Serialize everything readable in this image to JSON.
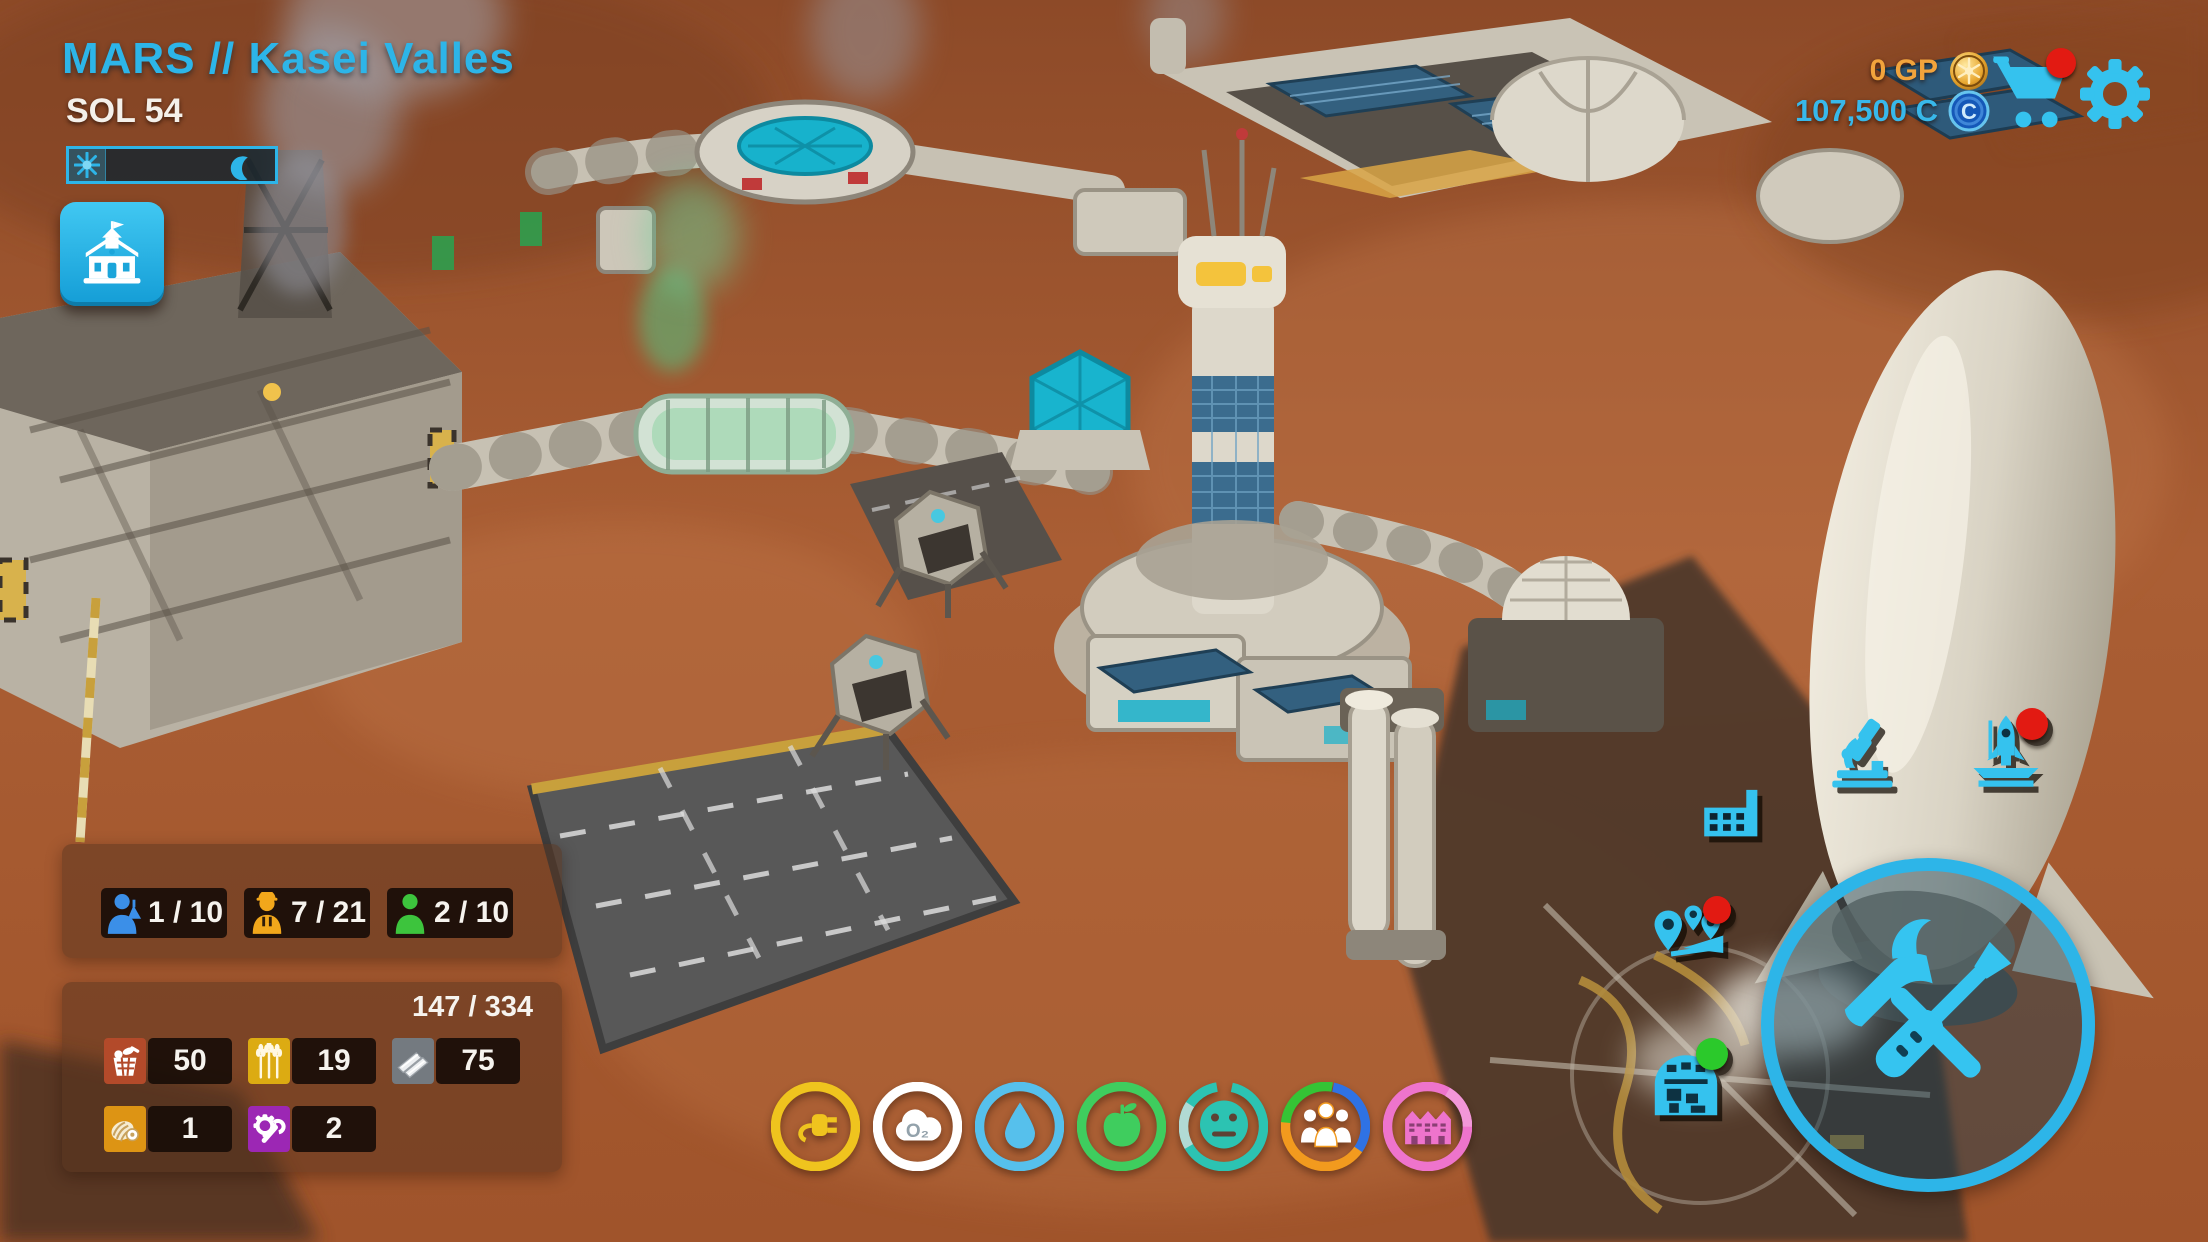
{
  "accent": "#2db5e8",
  "header": {
    "location": "MARS // Kasei Valles",
    "sol": "SOL 54"
  },
  "wallet": {
    "gp": "0 GP",
    "gp_color": "#f2a43c",
    "credits": "107,500 C",
    "credits_color": "#38b8ea",
    "coin_letter": "C"
  },
  "notifications": {
    "cart_badge": "#e21a12",
    "launch_badge": "#e21a12",
    "missions_badge": "#e21a12",
    "depot_badge": "#2bc92b"
  },
  "population": {
    "groups": [
      {
        "name": "scientists",
        "value": "1 / 10",
        "color": "#3b8fe8"
      },
      {
        "name": "engineers",
        "value": "7 / 21",
        "color": "#f2a71b"
      },
      {
        "name": "colonists",
        "value": "2 / 10",
        "color": "#3dc43d"
      }
    ]
  },
  "resources": {
    "storage": "147 / 334",
    "items": [
      {
        "name": "supplies",
        "value": "50",
        "color": "#b34a2a"
      },
      {
        "name": "crops",
        "value": "19",
        "color": "#dcab12"
      },
      {
        "name": "metal",
        "value": "75",
        "color": "#747a80"
      },
      {
        "name": "cable",
        "value": "1",
        "color": "#dd9414"
      },
      {
        "name": "spare-parts",
        "value": "2",
        "color": "#9c27b4"
      }
    ]
  },
  "status_rings": [
    {
      "name": "power",
      "color": "#efc41e"
    },
    {
      "name": "oxygen",
      "color": "#ffffff",
      "label": "O₂"
    },
    {
      "name": "water",
      "color": "#56c0ec"
    },
    {
      "name": "food",
      "color": "#3fcd5e"
    },
    {
      "name": "morale",
      "color": "#2cc3b2",
      "gap_color": "#c9ded9"
    },
    {
      "name": "population",
      "colors": [
        "#35c435",
        "#2f72e4",
        "#f29a1e"
      ],
      "icon_color": "#ffffff"
    },
    {
      "name": "housing",
      "color": "#ee74cc",
      "gap_color": "#f4a6dd"
    }
  ]
}
